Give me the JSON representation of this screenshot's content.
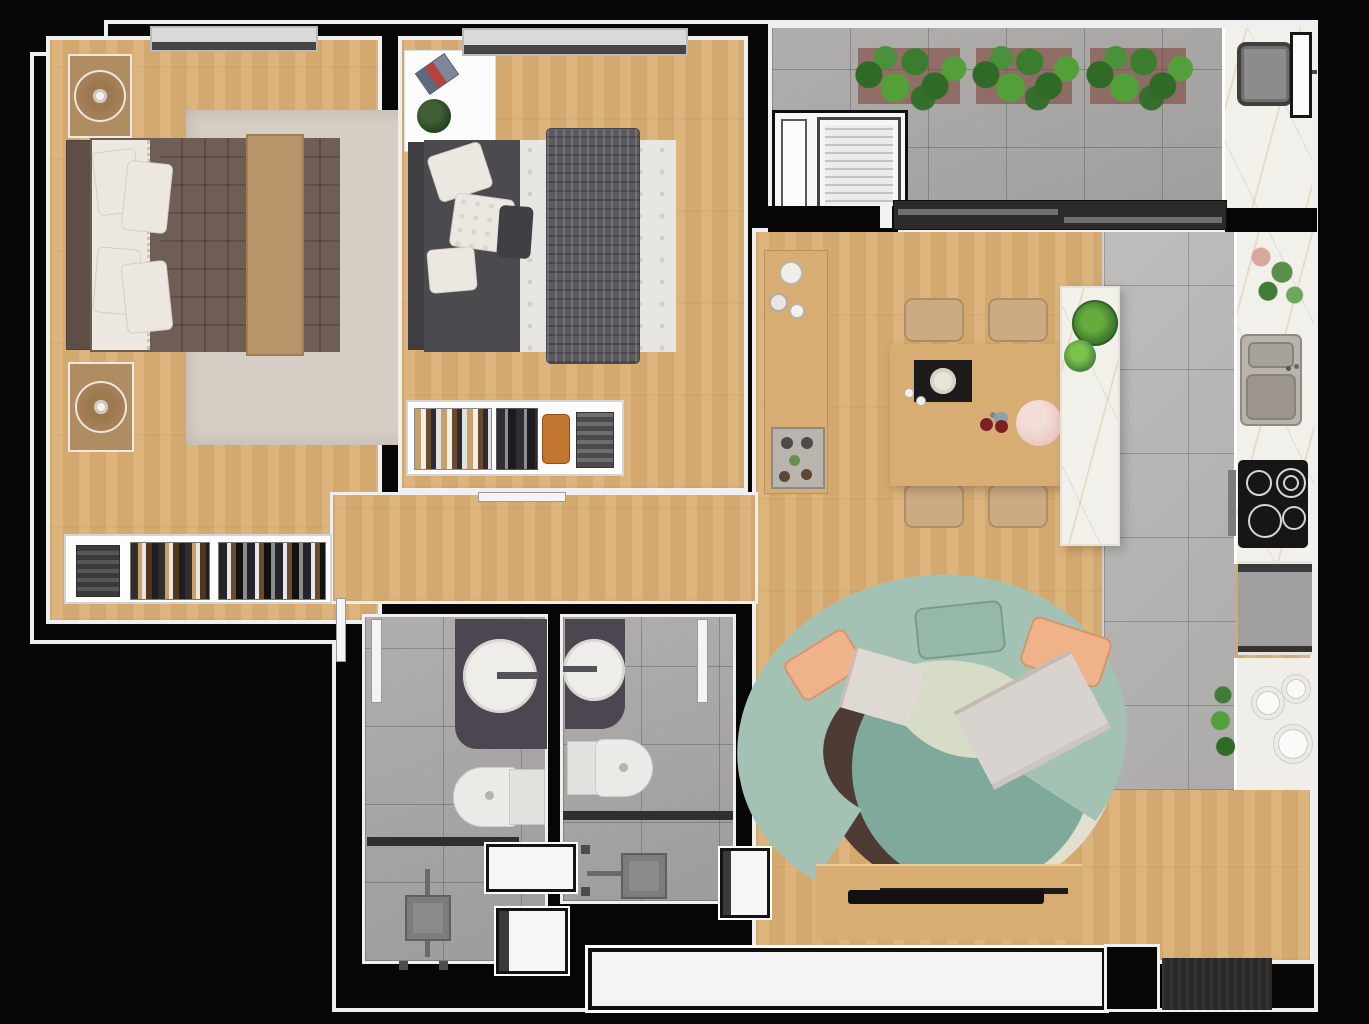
{
  "scene": {
    "type": "apartment-floor-plan",
    "view": "top-down-3d-render",
    "visible_text": []
  },
  "colors": {
    "bg": "#060606",
    "wall_outline": "#efefef",
    "wood": "#d9ae74",
    "wood_dark": "#c99c62",
    "rug_beige": "#d6cec4",
    "tile": "#b7b6b4",
    "tile_dark": "#a9a8a6",
    "marble": "#f2f0eb",
    "bed_brown": "#6f5e55",
    "bed_brown_dark": "#5d4e46",
    "runner_tan": "#b79569",
    "pillow_white": "#ece7e0",
    "bed2_dark": "#4a4a4f",
    "throw_gray": "#5a5a5f",
    "duvet_white": "#e7e6e3",
    "sofa_sage": "#a3c2b4",
    "pillow_peach": "#efb289",
    "rug_cream": "#e3dfcf",
    "rug_teal": "#7ea99b",
    "rug_brown": "#4e3c34",
    "rug_pale": "#d6dcc6",
    "furn_wood": "#d8ad74",
    "chair_tan": "#ccab83",
    "vanity_dark": "#4d4550",
    "fixture_white": "#efedea",
    "appliance_gray": "#a0a0a0",
    "cooktop_black": "#161616",
    "plant_green": "#53a03b",
    "plant_green_dark": "#2f6b27",
    "slider_dark": "#2a2a2a",
    "doormat_dark": "#2b2927",
    "counter_white": "#f0eee9",
    "pitcher_pink": "#ecc9c4",
    "accent_red": "#7e1f24",
    "window_gray": "#d9d9d9"
  },
  "rooms": [
    {
      "id": "master-bedroom",
      "furniture": [
        "double-bed-brown",
        "nightstand-lamp-1",
        "nightstand-lamp-2",
        "area-rug",
        "open-closet-clothes",
        "top-window"
      ]
    },
    {
      "id": "second-bedroom",
      "furniture": [
        "double-bed-gray",
        "side-table-with-book-and-plant",
        "area-rug",
        "open-closet-clothes",
        "top-window"
      ]
    },
    {
      "id": "balcony-terrace",
      "furniture": [
        "planter-1",
        "planter-2",
        "planter-3",
        "laundry-niche-washer",
        "bbq-counter-sink",
        "sliding-glass-door",
        "window"
      ]
    },
    {
      "id": "kitchen",
      "furniture": [
        "marble-counter",
        "double-sink",
        "cooktop-4-burners",
        "oven-handle",
        "fridge",
        "lower-counter-plates",
        "counter-plant",
        "marble-island-with-plants"
      ]
    },
    {
      "id": "dining-area",
      "furniture": [
        "wood-table",
        "chair-1",
        "chair-2",
        "chair-3",
        "chair-4",
        "placemat-plate",
        "pitcher",
        "sideboard-vases-coffee-tray"
      ]
    },
    {
      "id": "living-room",
      "furniture": [
        "curved-sage-sofa",
        "peach-pillows",
        "white-throws",
        "round-layered-rug",
        "tv-stand",
        "tv",
        "bottom-window"
      ]
    },
    {
      "id": "bathroom-1",
      "furniture": [
        "vanity-round-sink",
        "toilet",
        "shower-glass-divider",
        "shower-fixture",
        "door-leaf"
      ]
    },
    {
      "id": "bathroom-2",
      "furniture": [
        "vanity-round-sink",
        "toilet",
        "shower-glass-divider",
        "shower-fixture",
        "door-leaf"
      ]
    },
    {
      "id": "hallway",
      "furniture": [
        "door-a",
        "door-b",
        "door-c"
      ]
    },
    {
      "id": "entry",
      "furniture": [
        "doormat"
      ]
    }
  ]
}
